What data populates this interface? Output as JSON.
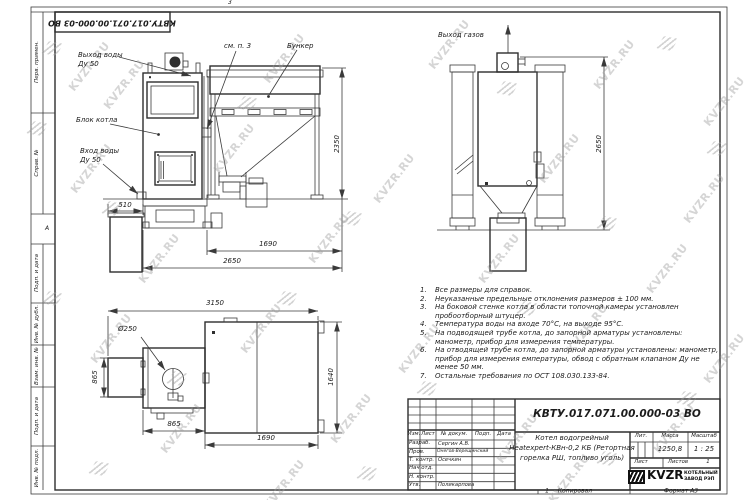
{
  "sheet": {
    "designation_top": "КВТУ.017.071.00.000-03 ВО",
    "zone_digit": "3",
    "zone_letter": "А",
    "frame_labels": [
      "Перв. примен.",
      "Справ. №",
      "Подп. и дата",
      "Инв. № дубл.",
      "Взам. инв. №",
      "Подп. и дата",
      "Инв. № подл."
    ]
  },
  "watermark": {
    "text": "KVZR.RU"
  },
  "callouts": {
    "water_out_1": "Выход воды",
    "water_out_2": "Ду 50",
    "boiler_block": "Блок котла",
    "water_in_1": "Вход воды",
    "water_in_2": "Ду 50",
    "see_note": "см. п. 3",
    "bunker": "Бункер",
    "gas_out": "Выход газов"
  },
  "dims": {
    "d510": "510",
    "d1690_front": "1690",
    "d2650_front": "2650",
    "d2350": "2350",
    "d2650_side": "2650",
    "d3150": "3150",
    "d250": "Ø250",
    "d865_left": "865",
    "d865_bottom": "865",
    "d1690_top": "1690",
    "d1640": "1640"
  },
  "notes": [
    {
      "num": "1.",
      "text": "Все размеры для справок."
    },
    {
      "num": "2.",
      "text": "Неуказанные предельные отклонения размеров ± 100 мм."
    },
    {
      "num": "3.",
      "text": "На боковой стенке котла в области топочной камеры установлен пробоотборный штуцер."
    },
    {
      "num": "4.",
      "text": "Температура воды на входе 70°С, на выходе 95°С."
    },
    {
      "num": "5.",
      "text": "На подводящей трубе котла, до запорной арматуры установлены: манометр, прибор для измерения температуры."
    },
    {
      "num": "6.",
      "text": "На отводящей трубе котла, до запорной арматуры установлены: манометр, прибор для измерения емпературы, обвод с обратным клапаном Ду не менее 50 мм."
    },
    {
      "num": "7.",
      "text": "Остальные требования по ОСТ 108.030.133-84."
    }
  ],
  "title_block": {
    "designation": "КВТУ.017.071.00.000-03 ВО",
    "name_line1": "Котел водогрейный",
    "name_line2": "Heatexpert-КВн-0,2 КБ (Ретортная",
    "name_line3": "горелка РШ, топливо уголь)",
    "col_izm": "Изм.",
    "col_list": "Лист",
    "col_doc": "№ докум.",
    "col_podp": "Подп.",
    "col_data": "Дата",
    "rows": [
      {
        "role": "Разраб.",
        "name": "Сергин А.В."
      },
      {
        "role": "Пров.",
        "name": "Онегов-Верещинский"
      },
      {
        "role": "Т. контр.",
        "name": "Осечкин"
      },
      {
        "role": "Нач.отд.",
        "name": ""
      },
      {
        "role": "Н. контр.",
        "name": ""
      },
      {
        "role": "Утв.",
        "name": "Поликарпова"
      }
    ],
    "lit_label": "Лит.",
    "mass_label": "Масса",
    "scale_label": "Масштаб",
    "mass": "1250,8",
    "scale": "1 : 25",
    "sheet_label": "Лист",
    "sheets_label": "Листов",
    "sheets_value": "1",
    "company_name": "KVZR",
    "company_line1": "КОТЕЛЬНЫЙ",
    "company_line2": "ЗАВОД РЭП",
    "footer_num": "1",
    "footer_copy": "Копировал",
    "footer_format": "Формат А3"
  }
}
